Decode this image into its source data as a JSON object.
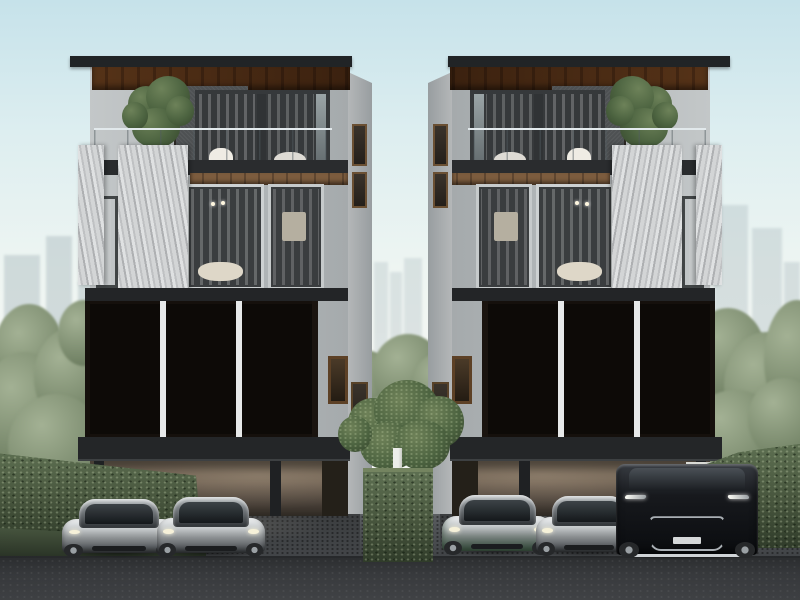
{
  "scene": {
    "description": "Photorealistic architectural rendering: two mirrored four-storey modern townhouses with bronze geometric lattice screens, marble slab accents, timber-soffit roofs, balcony trees and ground-level carports with luxury cars; hazy city skyline and greenery behind",
    "buildings_count": 2,
    "cars_count": 5
  },
  "palette": {
    "sky_top": "#c6e2ea",
    "sky_horizon": "#f5f7f4",
    "skyline": "#b6c4c8",
    "roof": "#212426",
    "wood": "#8d6b48",
    "wood_dark": "#6f5238",
    "wall_light": "#b3b8ba",
    "wall_dark": "#4e5153",
    "side_face": "#989da0",
    "marble": "#cbcdcf",
    "glass_warm": "#b68f5e",
    "frame": "#36393b",
    "band": "#2a2c2e",
    "screen_bg": "#15100c",
    "mullion": "#e7e9e9",
    "carport_top": "#8a7a68",
    "column": "#1f2123",
    "pavement": "#53565a",
    "road": "#35373a",
    "hedge": "#4e5f44",
    "tree": "#4c6340",
    "bg_tree": "#7b8b6e",
    "post": "#dadbd6",
    "car_silver": "#c4c8ca",
    "van_black": "#17191d"
  },
  "screens": {
    "panels_per_building": 3,
    "cols": 7,
    "rows": 13,
    "seed": 20240607,
    "facet_palette": [
      "#cdb695",
      "#a78c6a",
      "#6e573f",
      "#221a12",
      "#120d09",
      "#bfa57f"
    ]
  },
  "cars": [
    {
      "kind": "sports",
      "x": 62,
      "y": 499,
      "w": 114,
      "h": 56
    },
    {
      "kind": "sports",
      "x": 157,
      "y": 497,
      "w": 108,
      "h": 58
    },
    {
      "kind": "sports",
      "x": 442,
      "y": 495,
      "w": 110,
      "h": 58,
      "tint": "green"
    },
    {
      "kind": "sports",
      "x": 536,
      "y": 496,
      "w": 106,
      "h": 58
    },
    {
      "kind": "van",
      "x": 616,
      "y": 460,
      "w": 142,
      "h": 97
    }
  ]
}
